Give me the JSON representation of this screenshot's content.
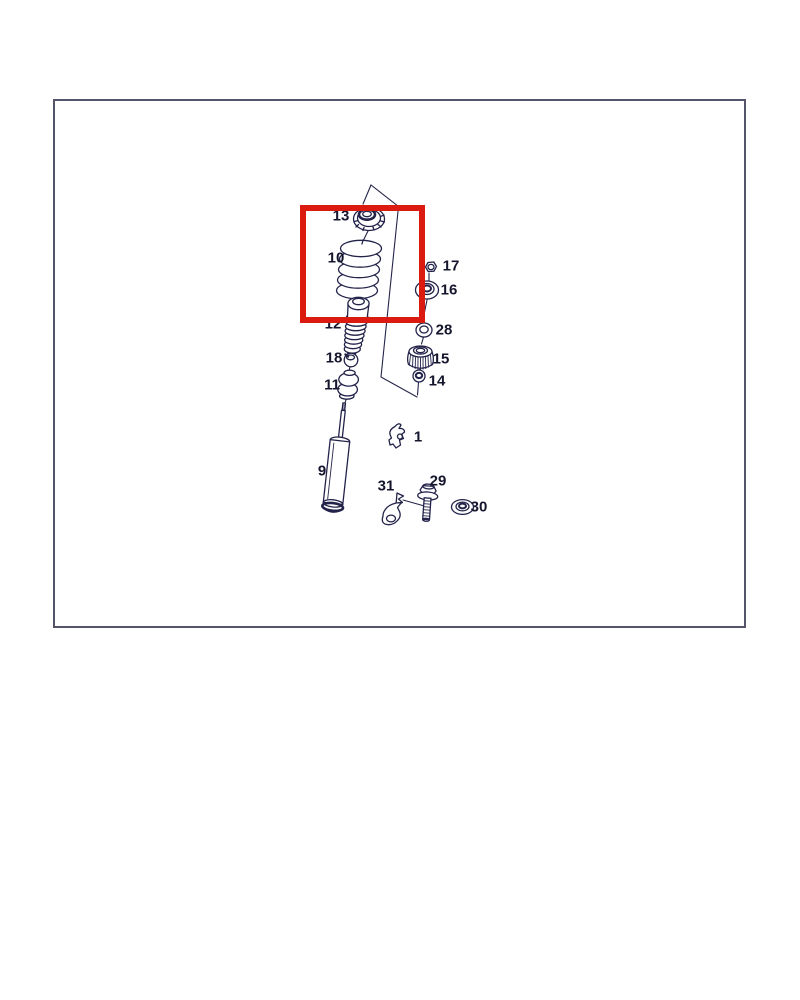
{
  "diagram": {
    "type": "exploded-parts-diagram",
    "description": "suspension shock absorber and coil spring exploded view",
    "part_labels": [
      {
        "label": "13"
      },
      {
        "label": "10"
      },
      {
        "label": "12"
      },
      {
        "label": "18"
      },
      {
        "label": "11"
      },
      {
        "label": "9"
      },
      {
        "label": "1"
      },
      {
        "label": "31"
      },
      {
        "label": "29"
      },
      {
        "label": "30"
      },
      {
        "label": "17"
      },
      {
        "label": "16"
      },
      {
        "label": "28"
      },
      {
        "label": "15"
      },
      {
        "label": "14"
      }
    ],
    "highlighted_labels": [
      "13",
      "10"
    ],
    "colors": {
      "highlight_box": "#dc1b10",
      "line_art": "#23234a",
      "outer_frame": "#54546a",
      "background": "#ffffff"
    }
  }
}
